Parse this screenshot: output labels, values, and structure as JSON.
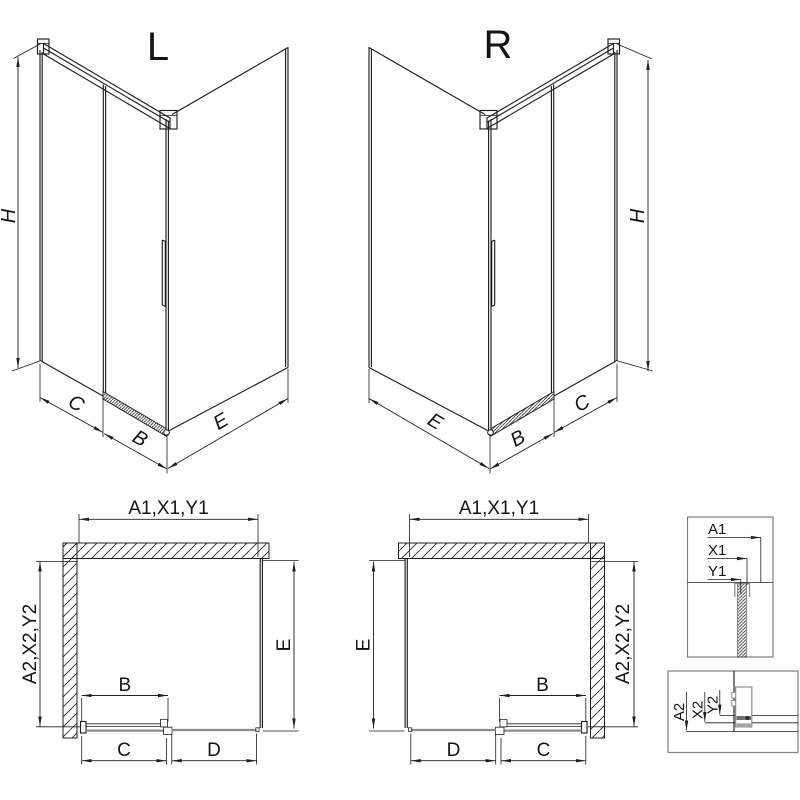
{
  "iso_views": [
    {
      "title": "L",
      "height_label": "H",
      "dim_c": "C",
      "dim_b": "B",
      "dim_e": "E"
    },
    {
      "title": "R",
      "height_label": "H",
      "dim_c": "C",
      "dim_b": "B",
      "dim_e": "E"
    }
  ],
  "plan_views": [
    {
      "width_label": "A1,X1,Y1",
      "depth_label": "A2,X2,Y2",
      "side_label": "E",
      "door_label": "B",
      "bottom_first": "C",
      "bottom_second": "D"
    },
    {
      "width_label": "A1,X1,Y1",
      "depth_label": "A2,X2,Y2",
      "side_label": "E",
      "door_label": "B",
      "bottom_first": "D",
      "bottom_second": "C"
    }
  ],
  "details": [
    {
      "labels": [
        "A1",
        "X1",
        "Y1"
      ]
    },
    {
      "labels": [
        "A2",
        "X2",
        "Y2"
      ]
    }
  ],
  "colors": {
    "line": "#1f1f1f",
    "profile_gray": "#8c8c8c",
    "detail_border": "#7f7f7f",
    "background": "#ffffff"
  }
}
